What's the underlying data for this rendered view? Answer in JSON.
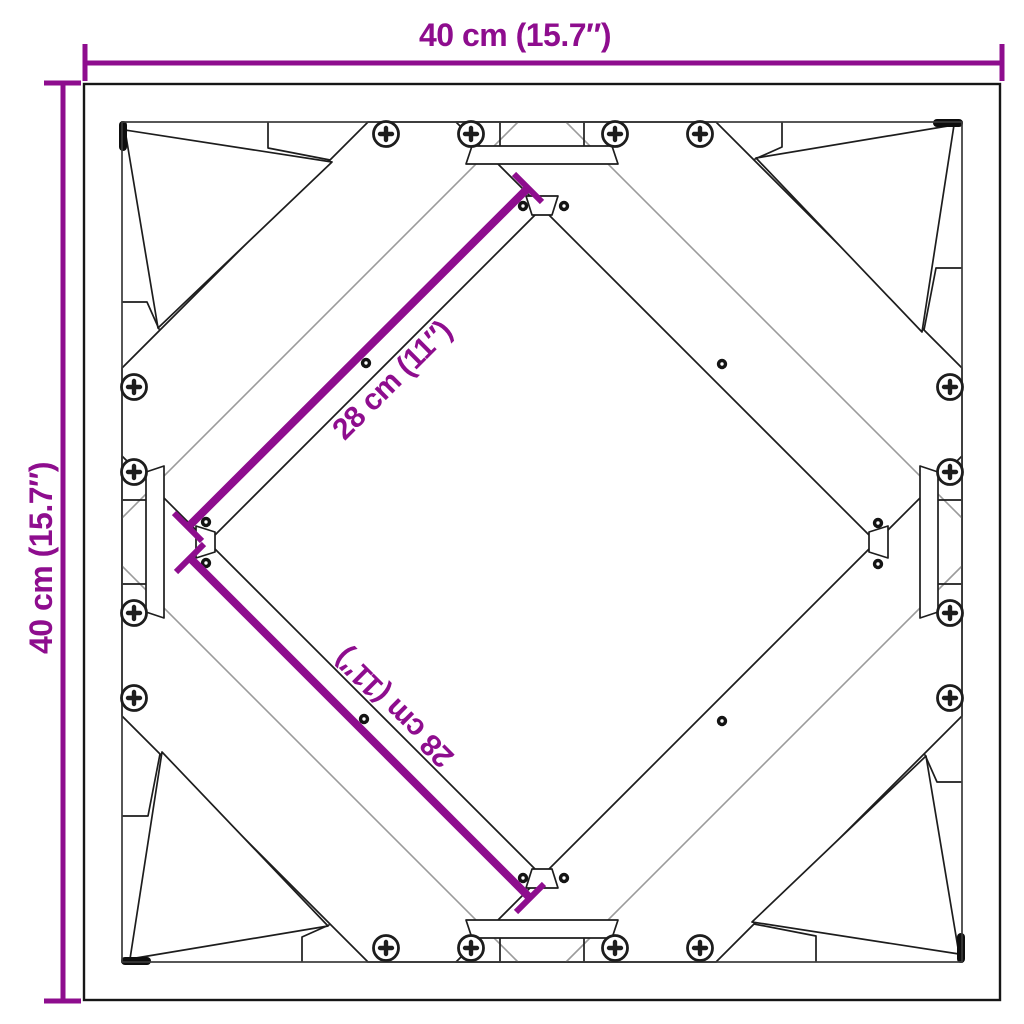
{
  "diagram": {
    "type": "product-dimension-drawing",
    "subject": "square metal table frame, top view, X cross-braces with corner legs",
    "background": "#ffffff",
    "accent_color": "#8E0D8E",
    "line_color": "#1d1d1d",
    "dimensions": {
      "top_width": {
        "label": "40 cm (15.7″)",
        "orientation": "horizontal-top"
      },
      "left_height": {
        "label": "40 cm (15.7″)",
        "orientation": "vertical-left"
      },
      "upper_brace": {
        "label": "28 cm (11″)",
        "orientation": "diagonal-45"
      },
      "lower_brace": {
        "label": "28 cm (11″)",
        "orientation": "diagonal-135"
      }
    },
    "hardware": {
      "phillips_screws": [
        [
          386,
          134
        ],
        [
          471,
          134
        ],
        [
          615,
          134
        ],
        [
          700,
          134
        ],
        [
          950,
          387
        ],
        [
          950,
          472
        ],
        [
          950,
          613
        ],
        [
          950,
          698
        ],
        [
          386,
          948
        ],
        [
          471,
          948
        ],
        [
          615,
          948
        ],
        [
          700,
          948
        ],
        [
          134,
          387
        ],
        [
          134,
          472
        ],
        [
          134,
          613
        ],
        [
          134,
          698
        ]
      ],
      "pin_screws": [
        [
          523,
          206
        ],
        [
          564,
          206
        ],
        [
          878,
          523
        ],
        [
          878,
          564
        ],
        [
          523,
          878
        ],
        [
          564,
          878
        ],
        [
          206,
          522
        ],
        [
          206,
          563
        ],
        [
          366,
          363
        ],
        [
          722,
          364
        ],
        [
          364,
          719
        ],
        [
          722,
          721
        ]
      ]
    }
  }
}
